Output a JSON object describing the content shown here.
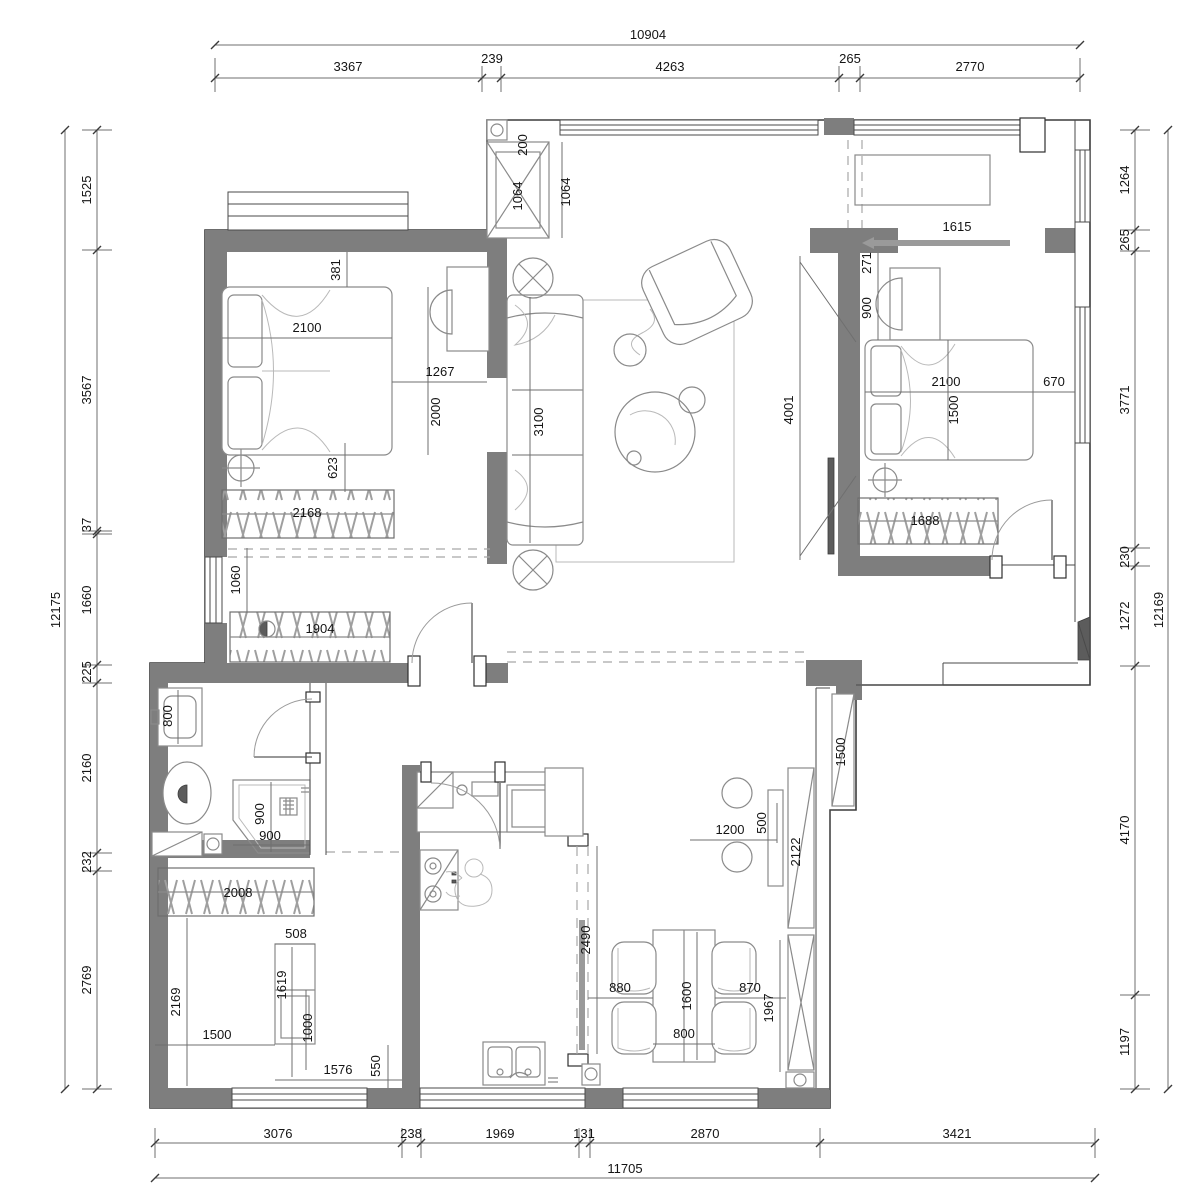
{
  "dims": {
    "top": {
      "total": "10904",
      "s": [
        "3367",
        "239",
        "4263",
        "265",
        "2770"
      ]
    },
    "bottom": {
      "total": "11705",
      "s": [
        "3076",
        "238",
        "1969",
        "131",
        "2870",
        "3421"
      ]
    },
    "left": {
      "total": "12175",
      "s": [
        "1525",
        "3567",
        "37",
        "1660",
        "225",
        "2160",
        "232",
        "2769"
      ]
    },
    "right": {
      "total": "12169",
      "s": [
        "1264",
        "265",
        "3771",
        "230",
        "1272",
        "4170",
        "1197"
      ]
    },
    "bedroom1": {
      "gap_top": "381",
      "bed_w": "2100",
      "bed_l": "2000",
      "side": "1267",
      "gap_bottom": "623",
      "wardrobe": "2168",
      "closet": "1904",
      "niche": "1060"
    },
    "living": {
      "shaft_depth": "200",
      "shaft_inner": "1064",
      "shaft": "1064",
      "sofa": "3100",
      "partition": "4001"
    },
    "bedroom2": {
      "slider": "1615",
      "gap_top": "271",
      "desk": "900",
      "bed_w": "2100",
      "bed_l": "1500",
      "side": "670",
      "wardrobe": "1688"
    },
    "bathroom": {
      "basin": "800",
      "shower_w": "900",
      "shower_d": "900"
    },
    "room3": {
      "wardrobe": "2008",
      "niche": "508",
      "desk_l": "1619",
      "desk_w": "1000",
      "width": "2169",
      "w1": "1500",
      "w2": "1576",
      "d1": "550"
    },
    "kitchen": {
      "slider": "2490"
    },
    "dining": {
      "bar_l": "1200",
      "bar_w": "500",
      "cab1": "2122",
      "cab2": "1500",
      "gap_l": "880",
      "table_l": "1600",
      "table_w": "800",
      "gap_r": "870",
      "cab3": "1967"
    }
  },
  "colors": {
    "wall": "#7e7e7e",
    "line": "#3c3c3c",
    "dim": "#141414"
  }
}
